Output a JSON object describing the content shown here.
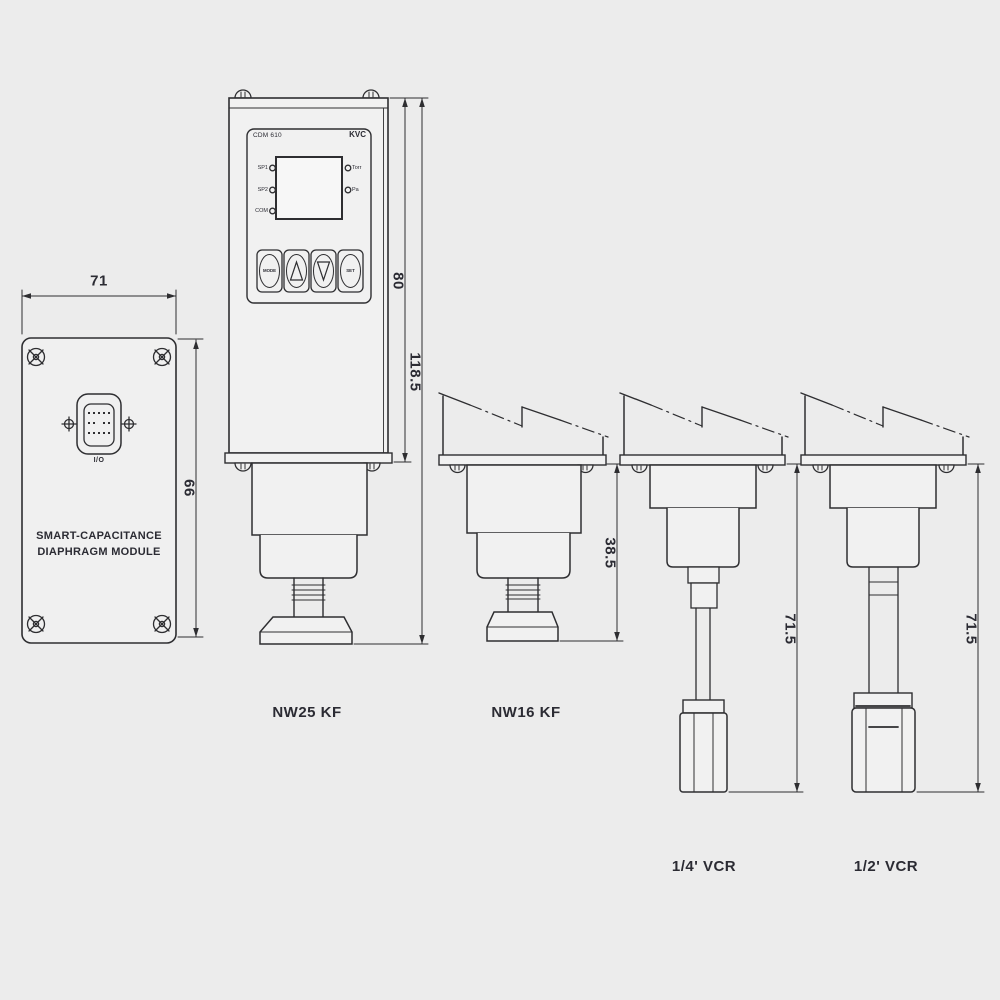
{
  "drawing": {
    "module": {
      "width_dim": "71",
      "height_dim": "66",
      "connector_label": "I/O",
      "title_line1": "SMART-CAPACITANCE",
      "title_line2": "DIAPHRAGM MODULE"
    },
    "controller": {
      "model": "CDM 610",
      "brand": "KVC",
      "led_left_1": "SP1",
      "led_left_2": "SP2",
      "led_left_3": "COM",
      "led_right_1": "Torr",
      "led_right_2": "Pa",
      "btn_mode": "MODE",
      "btn_set": "SET",
      "dim_housing": "80",
      "dim_total": "118.5"
    },
    "variants": {
      "v1_label": "NW25 KF",
      "v2_label": "NW16 KF",
      "v2_dim": "38.5",
      "v3_label": "1/4' VCR",
      "v3_dim": "71.5",
      "v4_label": "1/2' VCR",
      "v4_dim": "71.5"
    },
    "colors": {
      "line": "#2e2e31",
      "background": "#ececec"
    }
  }
}
